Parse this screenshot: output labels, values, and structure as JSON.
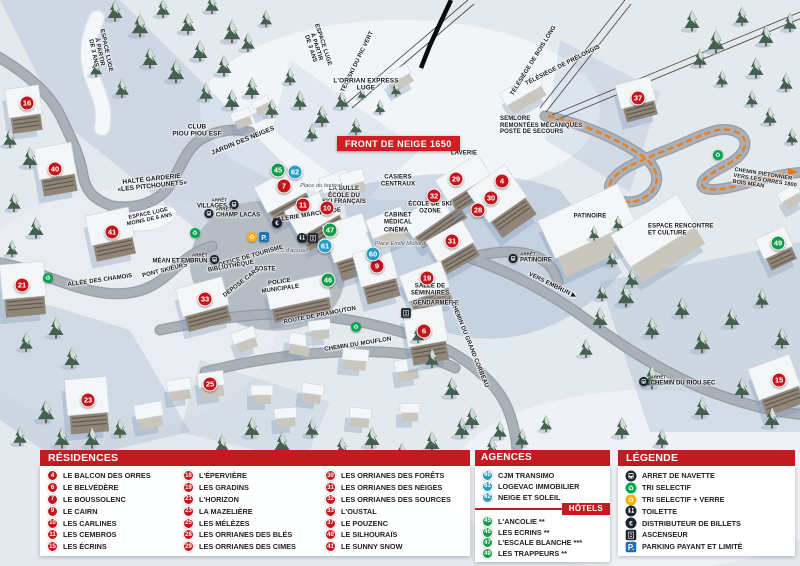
{
  "banner": {
    "text": "FRONT DE NEIGE 1650"
  },
  "colors": {
    "accent_red": "#c3161c",
    "marker_blue": "#2a9dc3",
    "marker_green": "#0f9d4a",
    "header_red": "#c41a21",
    "parking_blue": "#1a6fb7",
    "recycle_green": "#00a651",
    "verre_yellow": "#f9b000"
  },
  "map": {
    "bus_stop_prefix": "ARRÊT",
    "labels": [
      {
        "text": "CLUB\nPIOU PIOU ESF",
        "x": 197,
        "y": 131,
        "rot": 0,
        "size": 6.5
      },
      {
        "text": "JARDIN DES NEIGES",
        "x": 243,
        "y": 141,
        "rot": -22,
        "size": 6.5
      },
      {
        "text": "HALTE GARDERIE\n«LES PITCHOUNETS»",
        "x": 152,
        "y": 183,
        "rot": -6,
        "size": 6.5
      },
      {
        "text": "ESPACE LUGE\nÀ PARTIR\nDE 3 ANS",
        "x": 99,
        "y": 52,
        "rot": 78,
        "size": 6
      },
      {
        "text": "ESPACE LUGE\nÀ PARTIR\nDE 3 ANS",
        "x": 316,
        "y": 47,
        "rot": 72,
        "size": 6
      },
      {
        "text": "TÉLÉSKI DU PIC VERT",
        "x": 358,
        "y": 62,
        "rot": -64,
        "size": 6
      },
      {
        "text": "L'ORRIAN EXPRESS\nLUGE",
        "x": 366,
        "y": 85,
        "rot": 0,
        "size": 6.5
      },
      {
        "text": "TÉLÉSIÈGE DE BOIS LONG",
        "x": 534,
        "y": 61,
        "rot": -58,
        "size": 6
      },
      {
        "text": "TÉLÉSIÈGE DE PRÉLONGIS",
        "x": 563,
        "y": 66,
        "rot": -27,
        "size": 6
      },
      {
        "text": "SEMLORE\nREMONTÉES MÉCANIQUES\nPOSTE DE SECOURS",
        "x": 500,
        "y": 126,
        "rot": 0,
        "size": 6,
        "align": "left"
      },
      {
        "text": "LAVERIE",
        "x": 464,
        "y": 154,
        "rot": 0,
        "size": 6
      },
      {
        "text": "CASIERS\nCENTRAUX",
        "x": 398,
        "y": 181,
        "rot": 0,
        "size": 6
      },
      {
        "text": "LA BULLE\nÉCOLE DU\nSKI FRANÇAIS",
        "x": 344,
        "y": 196,
        "rot": 0,
        "size": 6
      },
      {
        "text": "GALERIE MARCHANDE",
        "x": 307,
        "y": 216,
        "rot": -9,
        "size": 6
      },
      {
        "text": "ÉCOLE DE SKI\nOZONE",
        "x": 430,
        "y": 208,
        "rot": 0,
        "size": 6
      },
      {
        "text": "CABINET\nMÉDICAL",
        "x": 398,
        "y": 219,
        "rot": 0,
        "size": 6
      },
      {
        "text": "CINÉMA",
        "x": 396,
        "y": 231,
        "rot": 0,
        "size": 6
      },
      {
        "text": "Place Émile Mollard",
        "x": 400,
        "y": 244,
        "rot": 0,
        "size": 5.5,
        "italic": true
      },
      {
        "text": "Place du festival",
        "x": 321,
        "y": 186,
        "rot": 0,
        "size": 5.5,
        "italic": true
      },
      {
        "text": "Place d'accueil",
        "x": 289,
        "y": 251,
        "rot": 0,
        "size": 5.5,
        "italic": true
      },
      {
        "text": "OFFICE DE TOURISME",
        "x": 251,
        "y": 257,
        "rot": -16,
        "size": 6
      },
      {
        "text": "BIBLIOTHÈQUE",
        "x": 231,
        "y": 267,
        "rot": -10,
        "size": 6
      },
      {
        "text": "POSTE",
        "x": 265,
        "y": 270,
        "rot": 0,
        "size": 6
      },
      {
        "text": "DÉPOSE CARS",
        "x": 242,
        "y": 283,
        "rot": -38,
        "size": 6
      },
      {
        "text": "POLICE\nMUNICIPALE",
        "x": 280,
        "y": 286,
        "rot": -8,
        "size": 6
      },
      {
        "text": "SALLE DE\nSÉMINAIRES",
        "x": 430,
        "y": 290,
        "rot": 0,
        "size": 6
      },
      {
        "text": "GENDARMERIE",
        "x": 436,
        "y": 304,
        "rot": 0,
        "size": 6
      },
      {
        "text": "ALLÉE DES CHAMOIS",
        "x": 100,
        "y": 281,
        "rot": -8,
        "size": 6
      },
      {
        "text": "PONT SKIEURS",
        "x": 165,
        "y": 271,
        "rot": -14,
        "size": 6
      },
      {
        "text": "ROUTE DE PRAMOUTON",
        "x": 320,
        "y": 316,
        "rot": -11,
        "size": 6
      },
      {
        "text": "CHEMIN DU MOUFLON",
        "x": 358,
        "y": 345,
        "rot": -9,
        "size": 6
      },
      {
        "text": "CHEMIN DU GRAND CORBEAU",
        "x": 469,
        "y": 345,
        "rot": 68,
        "size": 6
      },
      {
        "text": "VERS EMBRUN ▶",
        "x": 552,
        "y": 286,
        "rot": 26,
        "size": 6
      },
      {
        "text": "PATINOIRE",
        "x": 590,
        "y": 217,
        "rot": 0,
        "size": 6
      },
      {
        "text": "ESPACE RENCONTRE\nET CULTURE",
        "x": 648,
        "y": 230,
        "rot": 0,
        "size": 6,
        "align": "left"
      },
      {
        "text": "CHEMIN PIÉTONNIER\nVERS LES ORRES 1800\nBOIS MÉAN",
        "x": 733,
        "y": 181,
        "rot": 9,
        "size": 5.5,
        "align": "left"
      },
      {
        "text": "ESPACE LUGE\nMOINS DE 6 ANS",
        "x": 149,
        "y": 217,
        "rot": -12,
        "size": 5.5
      }
    ],
    "bus_stops": [
      {
        "name": "VILLAGES",
        "x": 218,
        "y": 204,
        "side": "left"
      },
      {
        "name": "CHAMP LACAS",
        "x": 232,
        "y": 213,
        "side": "right"
      },
      {
        "name": "MÉAN ET EMBRUN",
        "x": 186,
        "y": 259,
        "side": "left"
      },
      {
        "name": "PATINOIRE",
        "x": 530,
        "y": 258,
        "side": "right"
      },
      {
        "name": "CHEMIN DU RIOU SEC",
        "x": 677,
        "y": 381,
        "side": "right"
      }
    ],
    "icons": [
      {
        "type": "recycle",
        "x": 48,
        "y": 278
      },
      {
        "type": "recycle",
        "x": 195,
        "y": 233
      },
      {
        "type": "recycle",
        "x": 356,
        "y": 327
      },
      {
        "type": "recycle",
        "x": 718,
        "y": 155
      },
      {
        "type": "recycle-verre",
        "x": 252,
        "y": 237
      },
      {
        "type": "parking",
        "x": 264,
        "y": 237
      },
      {
        "type": "atm",
        "x": 277,
        "y": 223
      },
      {
        "type": "toilette",
        "x": 302,
        "y": 238
      },
      {
        "type": "ascenseur",
        "x": 313,
        "y": 238
      },
      {
        "type": "ascenseur",
        "x": 406,
        "y": 313
      }
    ],
    "markers": [
      {
        "n": "16",
        "color": "red",
        "x": 27,
        "y": 103
      },
      {
        "n": "40",
        "color": "red",
        "x": 55,
        "y": 169
      },
      {
        "n": "41",
        "color": "red",
        "x": 112,
        "y": 232
      },
      {
        "n": "21",
        "color": "red",
        "x": 22,
        "y": 285
      },
      {
        "n": "33",
        "color": "red",
        "x": 205,
        "y": 299
      },
      {
        "n": "23",
        "color": "red",
        "x": 88,
        "y": 400
      },
      {
        "n": "25",
        "color": "red",
        "x": 210,
        "y": 384
      },
      {
        "n": "7",
        "color": "red",
        "x": 284,
        "y": 186
      },
      {
        "n": "11",
        "color": "red",
        "x": 303,
        "y": 205
      },
      {
        "n": "10",
        "color": "red",
        "x": 327,
        "y": 208
      },
      {
        "n": "9",
        "color": "red",
        "x": 377,
        "y": 266
      },
      {
        "n": "29",
        "color": "red",
        "x": 456,
        "y": 179
      },
      {
        "n": "32",
        "color": "red",
        "x": 434,
        "y": 196
      },
      {
        "n": "4",
        "color": "red",
        "x": 502,
        "y": 181
      },
      {
        "n": "30",
        "color": "red",
        "x": 491,
        "y": 198
      },
      {
        "n": "28",
        "color": "red",
        "x": 478,
        "y": 210
      },
      {
        "n": "31",
        "color": "red",
        "x": 452,
        "y": 241
      },
      {
        "n": "19",
        "color": "red",
        "x": 427,
        "y": 278
      },
      {
        "n": "6",
        "color": "red",
        "x": 424,
        "y": 331
      },
      {
        "n": "37",
        "color": "red",
        "x": 638,
        "y": 98
      },
      {
        "n": "15",
        "color": "red",
        "x": 779,
        "y": 380
      },
      {
        "n": "62",
        "color": "blue",
        "x": 295,
        "y": 172
      },
      {
        "n": "61",
        "color": "blue",
        "x": 325,
        "y": 246
      },
      {
        "n": "60",
        "color": "blue",
        "x": 373,
        "y": 254
      },
      {
        "n": "45",
        "color": "green",
        "x": 278,
        "y": 170
      },
      {
        "n": "47",
        "color": "green",
        "x": 330,
        "y": 230
      },
      {
        "n": "46",
        "color": "green",
        "x": 328,
        "y": 280
      },
      {
        "n": "49",
        "color": "green",
        "x": 778,
        "y": 243
      }
    ]
  },
  "panels": {
    "residences": {
      "title": "RÉSIDENCES",
      "columns": [
        [
          {
            "n": "4",
            "label": "LE BALCON DES ORRES"
          },
          {
            "n": "6",
            "label": "LE BELVÉDÈRE"
          },
          {
            "n": "7",
            "label": "LE BOUSSOLENC"
          },
          {
            "n": "9",
            "label": "LE CAIRN"
          },
          {
            "n": "10",
            "label": "LES CARLINES"
          },
          {
            "n": "11",
            "label": "LES CEMBROS"
          },
          {
            "n": "15",
            "label": "LES ÉCRINS"
          }
        ],
        [
          {
            "n": "16",
            "label": "L'ÉPERVIÈRE"
          },
          {
            "n": "19",
            "label": "LES GRADINS"
          },
          {
            "n": "21",
            "label": "L'HORIZON"
          },
          {
            "n": "23",
            "label": "LA MAZELIÈRE"
          },
          {
            "n": "25",
            "label": "LES MÉLÈZES"
          },
          {
            "n": "28",
            "label": "LES ORRIANES DES BLÉS"
          },
          {
            "n": "29",
            "label": "LES ORRIANES DES CIMES"
          }
        ],
        [
          {
            "n": "30",
            "label": "LES ORRIANES DES FORÊTS"
          },
          {
            "n": "31",
            "label": "LES ORRIANES DES NEIGES"
          },
          {
            "n": "32",
            "label": "LES ORRIANES DES SOURCES"
          },
          {
            "n": "33",
            "label": "L'OUSTAL"
          },
          {
            "n": "37",
            "label": "LE POUZENC"
          },
          {
            "n": "40",
            "label": "LE SILHOURAÏS"
          },
          {
            "n": "41",
            "label": "LE SUNNY SNOW"
          }
        ]
      ]
    },
    "agences": {
      "title": "AGENCES IMMOBILIÈRES",
      "items": [
        {
          "n": "60",
          "label": "CJM TRANSIMO"
        },
        {
          "n": "61",
          "label": "LOGEVAC IMMOBILIER"
        },
        {
          "n": "62",
          "label": "NEIGE ET SOLEIL"
        }
      ]
    },
    "hotels": {
      "title": "HÔTELS",
      "items": [
        {
          "n": "45",
          "label": "L'ANCOLIE **"
        },
        {
          "n": "46",
          "label": "LES ECRINS **"
        },
        {
          "n": "47",
          "label": "L'ESCALE BLANCHE ***"
        },
        {
          "n": "49",
          "label": "LES TRAPPEURS **"
        }
      ]
    },
    "legende": {
      "title": "LÉGENDE",
      "items": [
        {
          "icon": "bus",
          "label": "ARRET DE NAVETTE"
        },
        {
          "icon": "recycle",
          "label": "TRI SELECTIF"
        },
        {
          "icon": "recycle-verre",
          "label": "TRI SELECTIF + VERRE"
        },
        {
          "icon": "toilette",
          "label": "TOILETTE"
        },
        {
          "icon": "atm",
          "label": "DISTRIBUTEUR DE BILLETS"
        },
        {
          "icon": "ascenseur",
          "label": "ASCENSEUR"
        },
        {
          "icon": "parking",
          "label": "PARKING PAYANT ET LIMITÉ"
        }
      ]
    }
  }
}
